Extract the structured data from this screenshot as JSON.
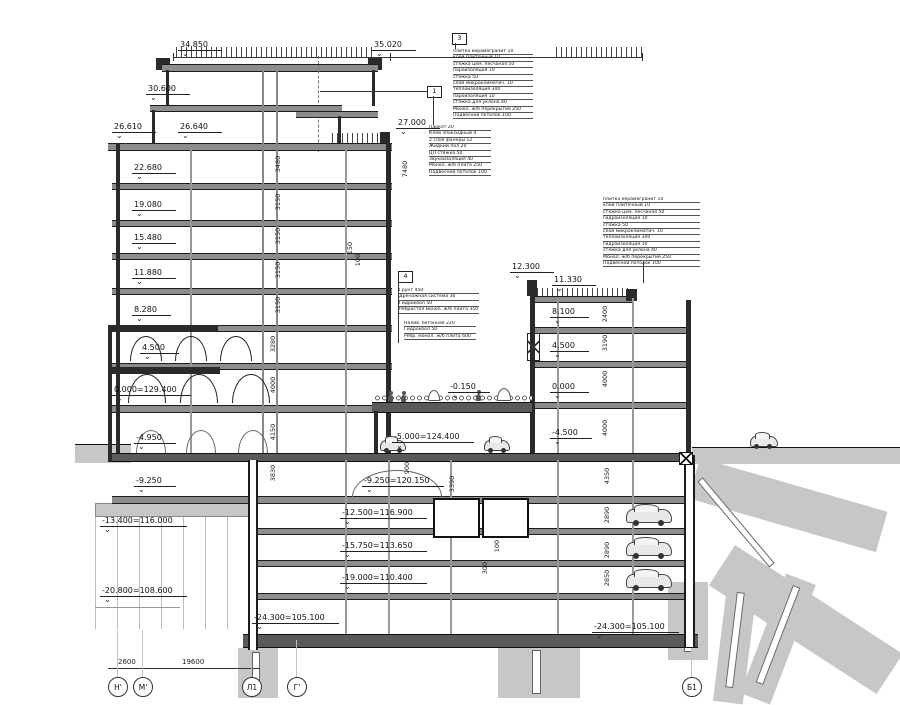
{
  "drawing": {
    "type": "building-cross-section",
    "colors": {
      "line": "#1c1c1c",
      "soil": "#c7c7c7",
      "slab": "#8d8d8d",
      "background": "#ffffff"
    }
  },
  "levels": {
    "l34850": "34.850",
    "l35020": "35.020",
    "l30600": "30.600",
    "l26610": "26.610",
    "l26640": "26.640",
    "l27000": "27.000",
    "l22680": "22.680",
    "l19080": "19.080",
    "l15480": "15.480",
    "l11880": "11.880",
    "l8280": "8.280",
    "l4500": "4.500",
    "l0000": "0.000=129.400",
    "lm4950": "-4.950",
    "lm9250": "-9.250",
    "lm13400": "-13.400=116.000",
    "lm20800": "-20.800=108.600",
    "r12300": "12.300",
    "r11330": "11.330",
    "r8100": "8.100",
    "r4500": "4.500",
    "r0000": "0.000",
    "rm4500": "-4.500",
    "p0150": "-0.150",
    "p5000": "-5.000=124.400",
    "p9250": "-9.250=120.150",
    "p12500": "-12.500=116.900",
    "p15750": "-15.750=113.650",
    "p19000": "-19.000=110.400",
    "p24300a": "-24.300=105.100",
    "p24300b": "-24.300=105.100"
  },
  "dims": {
    "d7480": "7480",
    "d3480": "3480",
    "d3150": "3150",
    "d3280": "3280",
    "d4000": "4000",
    "d4150": "4150",
    "d3830": "3830",
    "d2400": "2400",
    "d3190": "3190",
    "d4350": "4350",
    "d2890": "2890",
    "d2850": "2850",
    "d900": "900",
    "d3390": "3390",
    "d100": "100",
    "d300": "300",
    "d150": "150",
    "b2600": "2600",
    "b19600": "19600"
  },
  "axes": {
    "a1": "Н'",
    "a2": "М'",
    "a3": "Л1",
    "a4": "Г'",
    "a5": "Б1"
  },
  "callouts": {
    "c3": {
      "num": "3",
      "lines": [
        "плитка керамогранит 10",
        "клей плиточный 10",
        "стяжка цем. песчаная 50",
        "пароизоляция 10",
        "стяжка 50",
        "слой микроклиматич. 10",
        "теплоизоляция 300",
        "пароизоляция 10",
        "стяжка для уклона 40",
        "Монол. ж/б перекрытие 250",
        "Подвесной потолок 100"
      ]
    },
    "c1": {
      "num": "1",
      "lines": [
        "Паркет 20",
        "Клей эпоксидный 4",
        "2 слоя фанеры 12",
        "Жидкий пол 20",
        "ЦП стяжка 50",
        "Звукоизоляция 40",
        "Монол. ж/б плита 250",
        "Подвесной потолок 100"
      ]
    },
    "c2": {
      "lines": [
        "плитка керамогранит 10",
        "клей плиточный 10",
        "стяжка цем. песчаная 50",
        "гидроизоляция 10",
        "стяжка 50",
        "слой микроклиматич. 10",
        "теплоизоляция 300",
        "гидроизоляция 10",
        "стяжка для уклона 40",
        "Монол. ж/б перекрытие 250",
        "Подвесной потолок 100"
      ]
    },
    "c4": {
      "num": "4",
      "lines_a": [
        "Грунт 450",
        "Дренажная система 30",
        "Гидроизол 50",
        "Ребристая монол. ж/б плита 350"
      ],
      "lines_b": [
        "Налив. бетонная 220",
        "Гидроизол 50",
        "Ребр. монол. ж/б плита 600"
      ]
    }
  }
}
